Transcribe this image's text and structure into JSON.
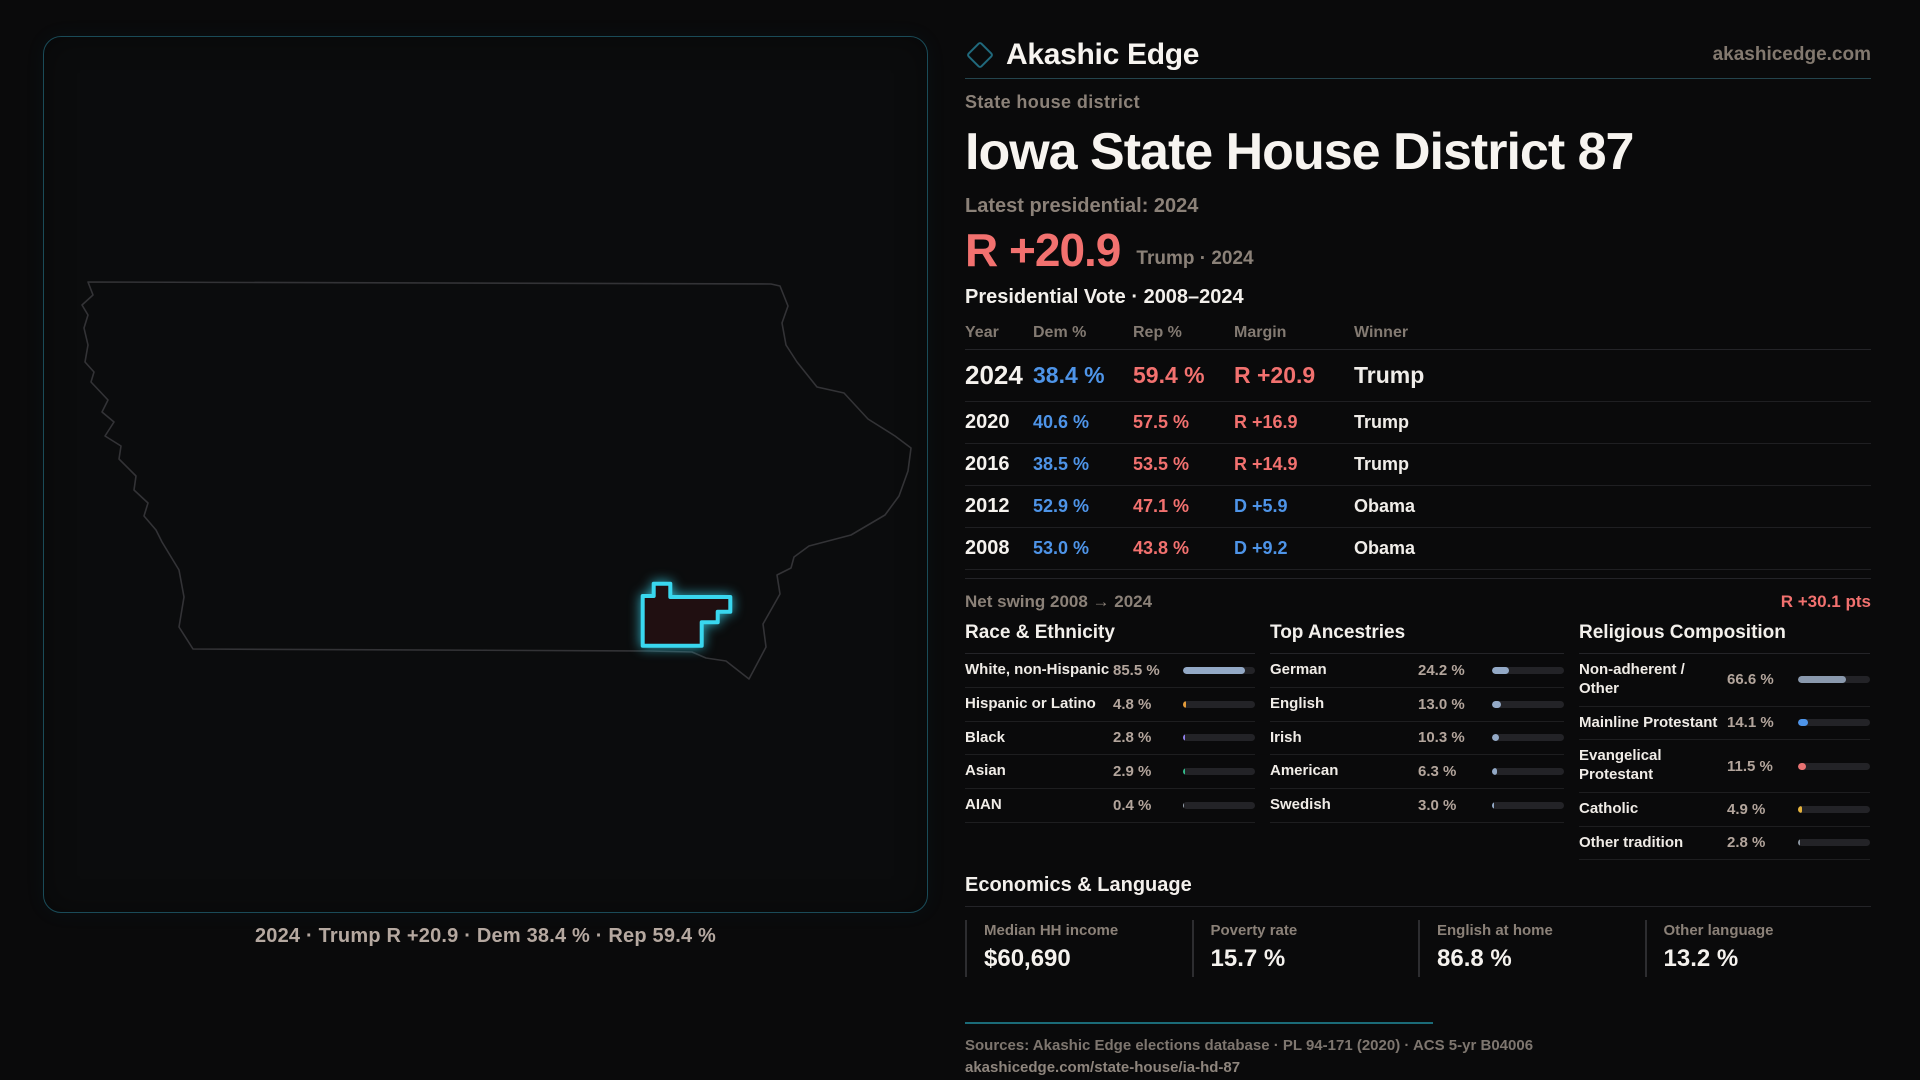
{
  "brand": {
    "name": "Akashic Edge",
    "domain": "akashicedge.com"
  },
  "page": {
    "kicker": "State house district",
    "title": "Iowa State House District 87",
    "latest_label": "Latest presidential: 2024",
    "headline_margin": "R +20.9",
    "headline_context": "Trump · 2024",
    "table_title": "Presidential Vote · 2008–2024"
  },
  "vote_table": {
    "columns": [
      "Year",
      "Dem %",
      "Rep %",
      "Margin",
      "Winner"
    ],
    "rows": [
      {
        "year": "2024",
        "dem": "38.4 %",
        "rep": "59.4 %",
        "margin": "R +20.9",
        "party": "R",
        "winner": "Trump",
        "featured": true
      },
      {
        "year": "2020",
        "dem": "40.6 %",
        "rep": "57.5 %",
        "margin": "R +16.9",
        "party": "R",
        "winner": "Trump",
        "featured": false
      },
      {
        "year": "2016",
        "dem": "38.5 %",
        "rep": "53.5 %",
        "margin": "R +14.9",
        "party": "R",
        "winner": "Trump",
        "featured": false
      },
      {
        "year": "2012",
        "dem": "52.9 %",
        "rep": "47.1 %",
        "margin": "D +5.9",
        "party": "D",
        "winner": "Obama",
        "featured": false
      },
      {
        "year": "2008",
        "dem": "53.0 %",
        "rep": "43.8 %",
        "margin": "D +9.2",
        "party": "D",
        "winner": "Obama",
        "featured": false
      }
    ]
  },
  "net_swing": {
    "label": "Net swing 2008 → 2024",
    "value": "R +30.1 pts"
  },
  "demographics": {
    "race": {
      "title": "Race & Ethnicity",
      "rows": [
        {
          "label": "White, non-Hispanic",
          "value": "85.5 %",
          "pct": 85.5,
          "color": "#93a9c6"
        },
        {
          "label": "Hispanic or Latino",
          "value": "4.8 %",
          "pct": 4.8,
          "color": "#e39b3a"
        },
        {
          "label": "Black",
          "value": "2.8 %",
          "pct": 2.8,
          "color": "#8f7fe8"
        },
        {
          "label": "Asian",
          "value": "2.9 %",
          "pct": 2.9,
          "color": "#33b98a"
        },
        {
          "label": "AIAN",
          "value": "0.4 %",
          "pct": 0.4,
          "color": "#9aa5b1"
        }
      ]
    },
    "ancestry": {
      "title": "Top Ancestries",
      "rows": [
        {
          "label": "German",
          "value": "24.2 %",
          "pct": 24.2,
          "color": "#93a9c6"
        },
        {
          "label": "English",
          "value": "13.0 %",
          "pct": 13.0,
          "color": "#93a9c6"
        },
        {
          "label": "Irish",
          "value": "10.3 %",
          "pct": 10.3,
          "color": "#93a9c6"
        },
        {
          "label": "American",
          "value": "6.3 %",
          "pct": 6.3,
          "color": "#93a9c6"
        },
        {
          "label": "Swedish",
          "value": "3.0 %",
          "pct": 3.0,
          "color": "#93a9c6"
        }
      ]
    },
    "religion": {
      "title": "Religious Composition",
      "rows": [
        {
          "label": "Non-adherent / Other",
          "value": "66.6 %",
          "pct": 66.6,
          "color": "#8a99ad"
        },
        {
          "label": "Mainline Protestant",
          "value": "14.1 %",
          "pct": 14.1,
          "color": "#4e94e8"
        },
        {
          "label": "Evangelical Protestant",
          "value": "11.5 %",
          "pct": 11.5,
          "color": "#e87272"
        },
        {
          "label": "Catholic",
          "value": "4.9 %",
          "pct": 4.9,
          "color": "#e6b33c"
        },
        {
          "label": "Other tradition",
          "value": "2.8 %",
          "pct": 2.8,
          "color": "#8b95a0"
        }
      ]
    }
  },
  "economics": {
    "title": "Economics & Language",
    "stats": [
      {
        "label": "Median HH income",
        "value": "$60,690"
      },
      {
        "label": "Poverty rate",
        "value": "15.7 %"
      },
      {
        "label": "English at home",
        "value": "86.8 %"
      },
      {
        "label": "Other language",
        "value": "13.2 %"
      }
    ]
  },
  "footer": {
    "sources": "Sources: Akashic Edge elections database · PL 94-171 (2020) · ACS 5-yr B04006",
    "url": "akashicedge.com/state-house/ia-hd-87"
  },
  "map": {
    "caption": "2024 · Trump R +20.9 · Dem 38.4 % · Rep 59.4 %",
    "highlight_color": "#39d7ef"
  },
  "colors": {
    "dem": "#4e94e8",
    "rep": "#f2716f",
    "accent": "#39d7ef"
  }
}
